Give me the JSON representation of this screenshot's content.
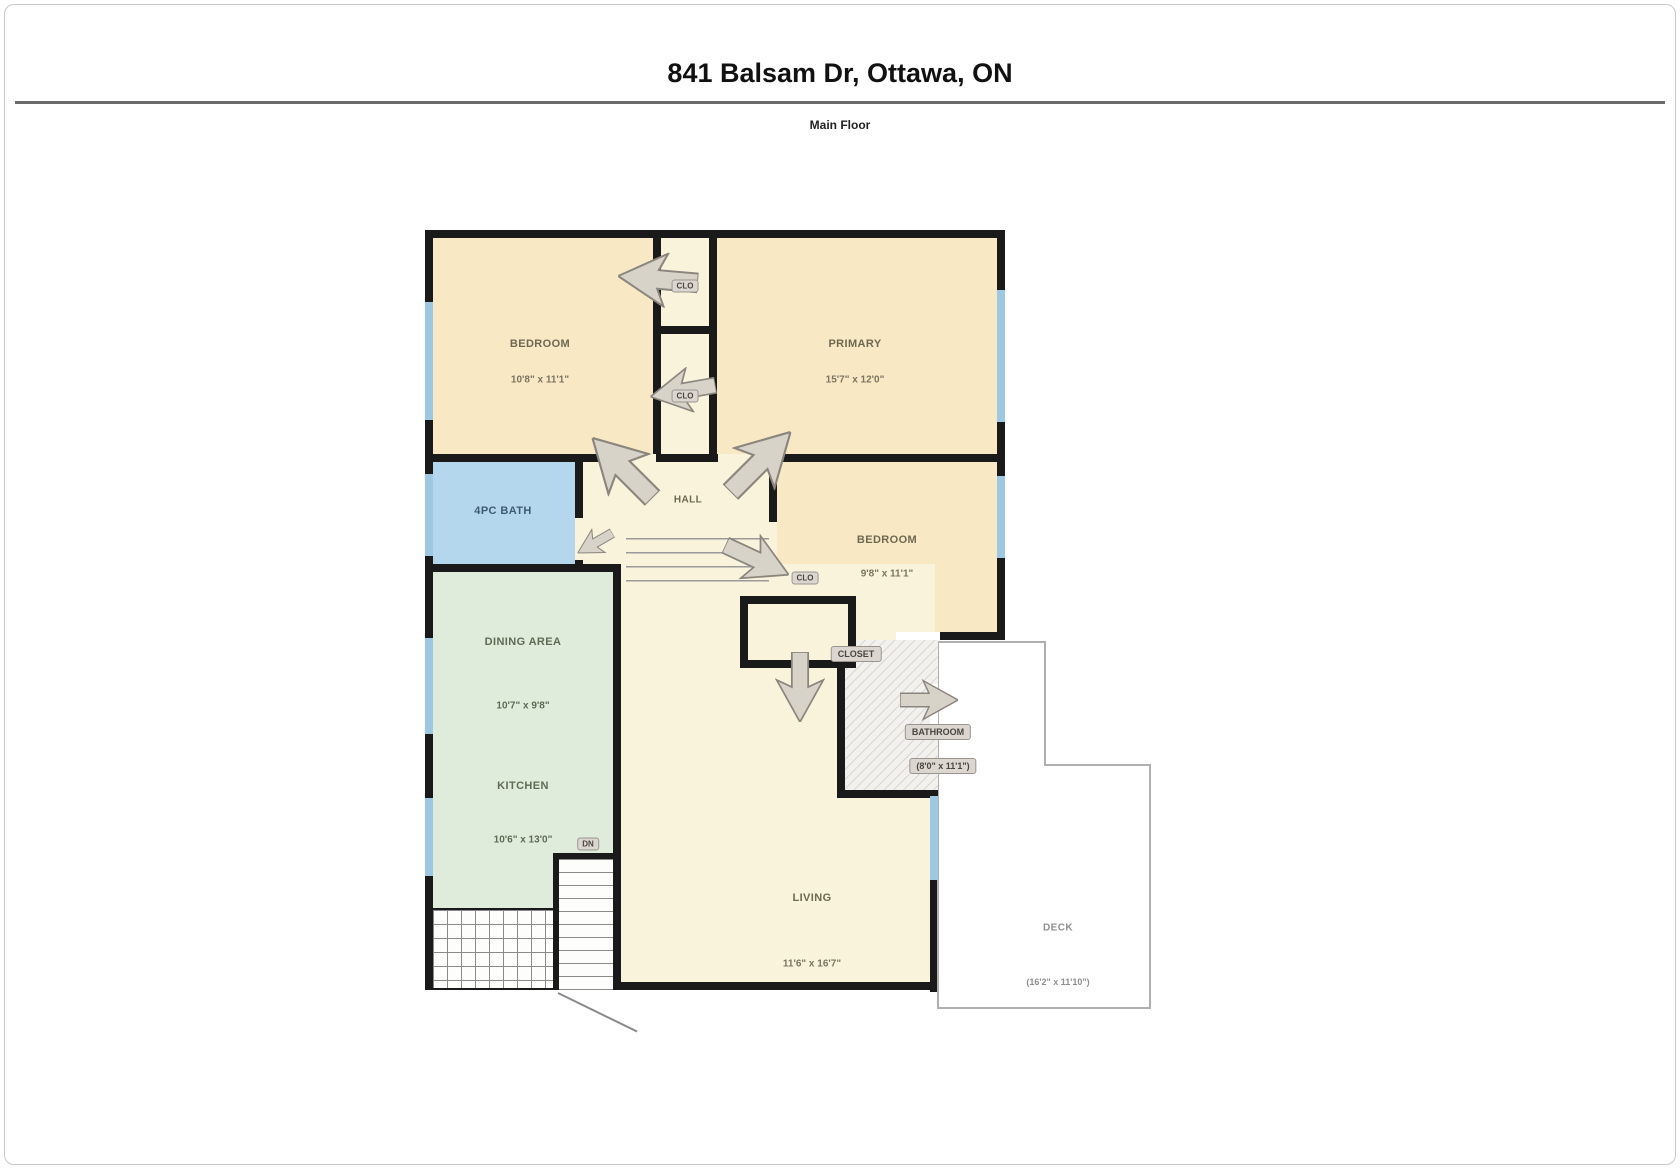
{
  "header": {
    "title": "841 Balsam Dr, Ottawa, ON",
    "subtitle": "Main Floor"
  },
  "rooms": {
    "bedroom1": {
      "label": "BEDROOM",
      "dim": "10'8\" x 11'1\""
    },
    "primary": {
      "label": "PRIMARY",
      "dim": "15'7\" x 12'0\""
    },
    "bath": {
      "label": "4PC BATH"
    },
    "hall": {
      "label": "HALL"
    },
    "bedroom2": {
      "label": "BEDROOM",
      "dim": "9'8\" x 11'1\""
    },
    "dining": {
      "label": "DINING AREA",
      "dim": "10'7\" x 9'8\""
    },
    "kitchen": {
      "label": "KITCHEN",
      "dim": "10'6\" x 13'0\""
    },
    "living": {
      "label": "LIVING",
      "dim": "11'6\" x 16'7\""
    },
    "bathroom": {
      "label": "BATHROOM",
      "dim": "(8'0\" x 11'1\")"
    },
    "deck": {
      "label": "DECK",
      "dim": "(16'2\" x 11'10\")"
    }
  },
  "chips": {
    "closet_top": "CLO",
    "closet_mid": "CLO",
    "closet_hall": "CLO",
    "closet_main": "CLOSET",
    "stairs_down": "DN"
  },
  "colors": {
    "room_beige": "#f8e9c4",
    "room_cream": "#faf3dc",
    "bath_blue": "#b5d7ee",
    "kitchen_green": "#dfecdc",
    "window_blue": "#9ec7e2",
    "wall": "#1a1a1a"
  }
}
